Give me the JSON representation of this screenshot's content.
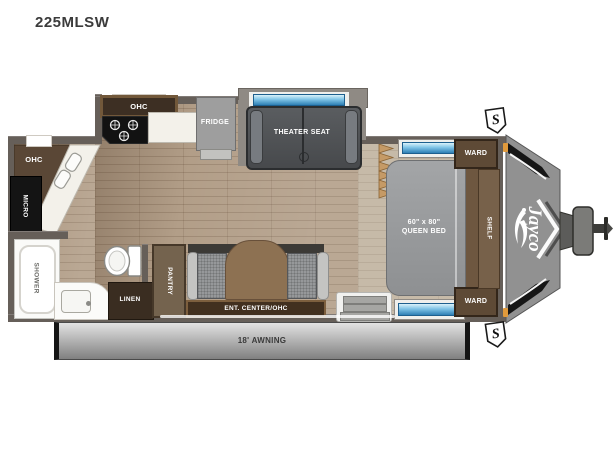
{
  "title": "225MLSW",
  "labels": {
    "kitchen_ohc": "OHC",
    "fridge": "FRIDGE",
    "theater_seat": "THEATER SEAT",
    "ward_top": "WARD",
    "ward_bottom": "WARD",
    "shelf": "SHELF",
    "bed_size": "60\" x 80\"",
    "bed_type": "QUEEN BED",
    "rear_ohc": "OHC",
    "micro": "MICRO",
    "shower": "SHOWER",
    "linen": "LINEN",
    "pantry": "PANTRY",
    "ent_center": "ENT. CENTER/OHC",
    "awning": "18' AWNING",
    "speaker": "S",
    "brand": "Jayco"
  },
  "colors": {
    "wall": "#665f59",
    "floor": "#b29e88",
    "bedroom_floor": "#c6baa8",
    "cabinet_dark": "#42301f",
    "cabinet": "#5e4a36",
    "window_blue": "#2e7fb5",
    "seat_gray": "#505356",
    "bed_gray": "#9b9c9e",
    "awning_gray": "#9a9a9a",
    "front_cap_gray": "#919191",
    "marker_orange": "#e09a3c"
  }
}
